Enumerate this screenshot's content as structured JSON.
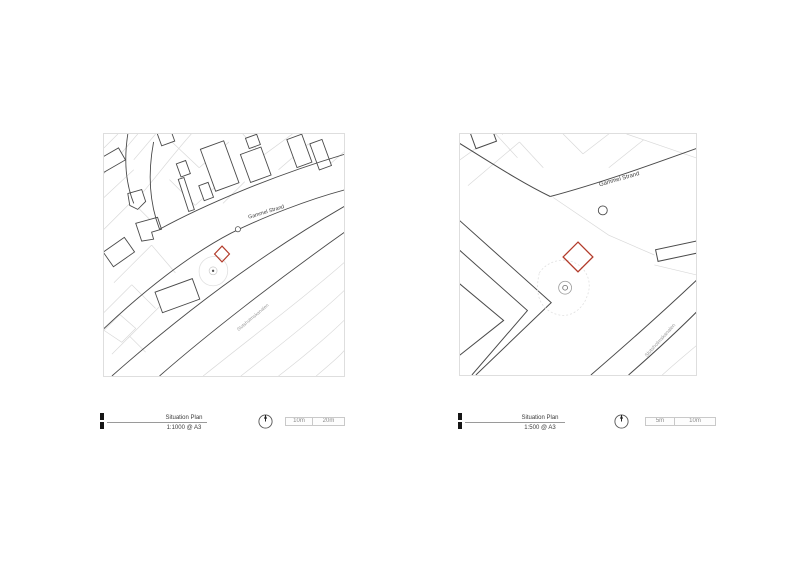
{
  "sheet": {
    "type": "architectural-situation-plan-sheet",
    "background": "#ffffff"
  },
  "colors": {
    "site_marker_red": "#b23b2a",
    "building_line": "#4a4a4a",
    "parcel_line": "#d9d9d9",
    "frame_border": "#dedede",
    "text_dark": "#3c3c3c",
    "text_muted": "#9a9a9a"
  },
  "panels": [
    {
      "name": "situation-plan-1-1000",
      "map": {
        "street_label": "Gammel Strand",
        "canal_label": "Slotsholmskanalen"
      },
      "title_block": {
        "title": "Situation Plan",
        "scale": "1:1000 @ A3"
      },
      "scale_bar": {
        "segments": [
          "10m",
          "20m"
        ]
      }
    },
    {
      "name": "situation-plan-1-500",
      "map": {
        "street_label": "Gammel Strand",
        "canal_label": "Slotsholmskanalen"
      },
      "title_block": {
        "title": "Situation Plan",
        "scale": "1:500 @ A3"
      },
      "scale_bar": {
        "segments": [
          "5m",
          "10m"
        ]
      }
    }
  ]
}
